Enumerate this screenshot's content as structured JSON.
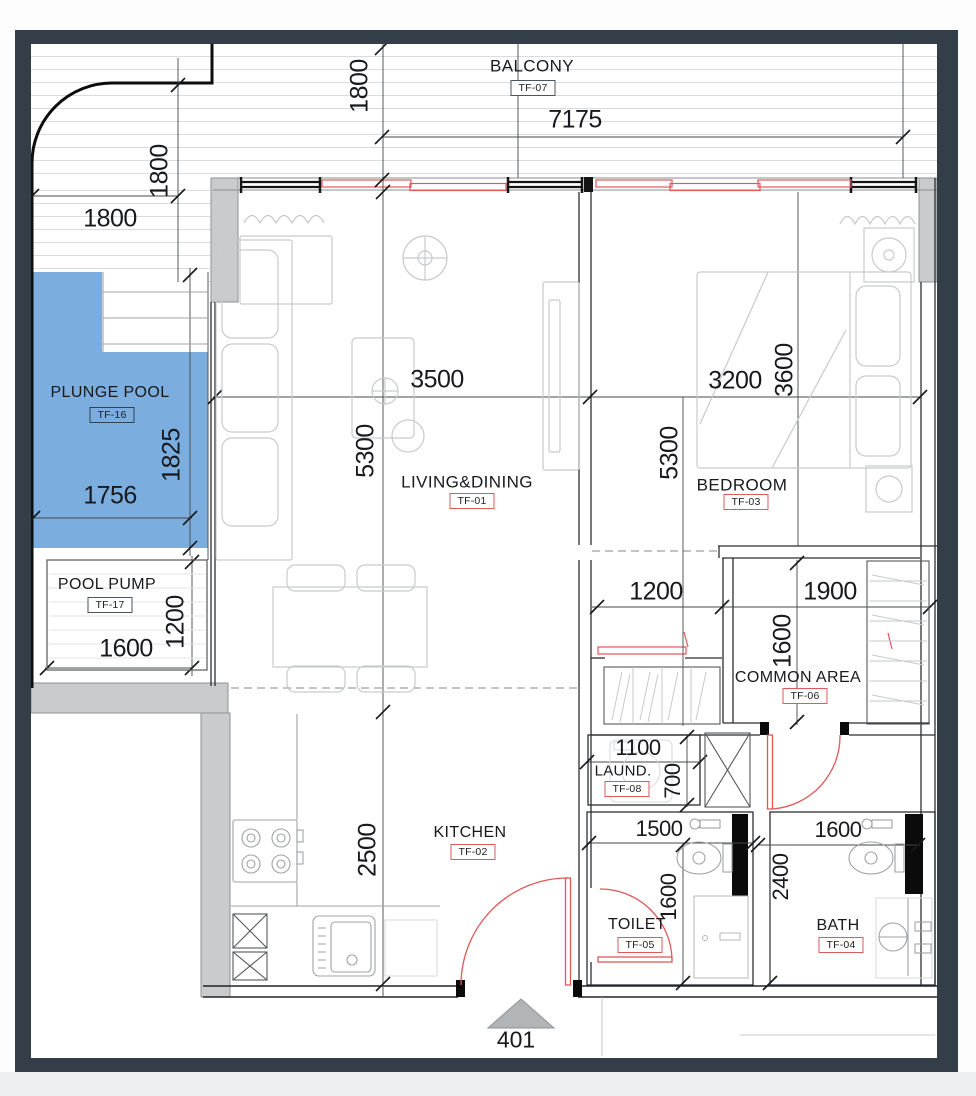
{
  "unit": {
    "number": "401"
  },
  "rooms": [
    {
      "id": "balcony",
      "label": "BALCONY",
      "tag": "TF-07",
      "tag_style": "dark"
    },
    {
      "id": "plunge-pool",
      "label": "PLUNGE POOL",
      "tag": "TF-16",
      "tag_style": "dark"
    },
    {
      "id": "pool-pump",
      "label": "POOL PUMP",
      "tag": "TF-17",
      "tag_style": "dark"
    },
    {
      "id": "living-dining",
      "label": "LIVING&DINING",
      "tag": "TF-01",
      "tag_style": "red"
    },
    {
      "id": "kitchen",
      "label": "KITCHEN",
      "tag": "TF-02",
      "tag_style": "red"
    },
    {
      "id": "bedroom",
      "label": "BEDROOM",
      "tag": "TF-03",
      "tag_style": "red"
    },
    {
      "id": "bath",
      "label": "BATH",
      "tag": "TF-04",
      "tag_style": "red"
    },
    {
      "id": "toilet",
      "label": "TOILET",
      "tag": "TF-05",
      "tag_style": "red"
    },
    {
      "id": "common-area",
      "label": "COMMON AREA",
      "tag": "TF-06",
      "tag_style": "red"
    },
    {
      "id": "laundry",
      "label": "LAUND.",
      "tag": "TF-08",
      "tag_style": "red"
    }
  ],
  "dimensions_mm": {
    "balcony_width": "7175",
    "balcony_depth": "1800",
    "corner_depth": "1800",
    "corner_width": "1800",
    "pool_length": "1825",
    "pool_width": "1756",
    "pool_pump_width": "1600",
    "pool_pump_depth": "1200",
    "living_width": "3500",
    "living_length": "5300",
    "bedroom_width": "3200",
    "bed_zone_width": "3600",
    "bedroom_length": "5300",
    "corridor_opening": "1200",
    "common_width": "1900",
    "common_depth": "1600",
    "laundry_width": "1100",
    "laundry_depth": "700",
    "kitchen_depth": "2500",
    "toilet_width": "1500",
    "toilet_depth": "1600",
    "bath_width": "1600",
    "bath_depth": "2400"
  },
  "colors": {
    "pool_fill": "#7badde",
    "frame": "#333e49",
    "wall_gray": "#c9cbcc",
    "tag_red": "#d95b5b",
    "window_red": "#e05858"
  }
}
